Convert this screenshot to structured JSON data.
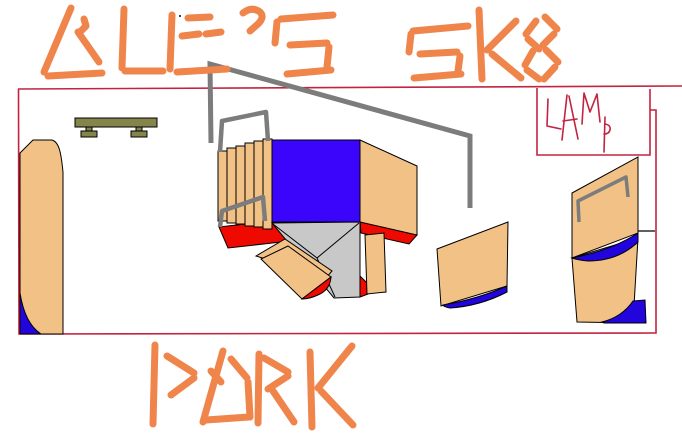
{
  "title": {
    "line1": "ALE'S SK8",
    "line2": "PARK",
    "full": "ALE'S SK8 PARK"
  },
  "lamp_box": {
    "label": "LAMP",
    "letters": [
      "L",
      "A",
      "M",
      "p"
    ]
  },
  "colors": {
    "background": "#FFFFFF",
    "title_orange": "#F0854B",
    "line_red": "#C22440",
    "shape_red": "#EE0A00",
    "tan": "#F2C185",
    "royal_blue": "#3A05FA",
    "deep_blue": "#2205DC",
    "rail_gray": "#7C7C7C",
    "ramp_gray": "#C8C8C8",
    "bench_olive": "#85854B",
    "outline_black": "#000000"
  }
}
